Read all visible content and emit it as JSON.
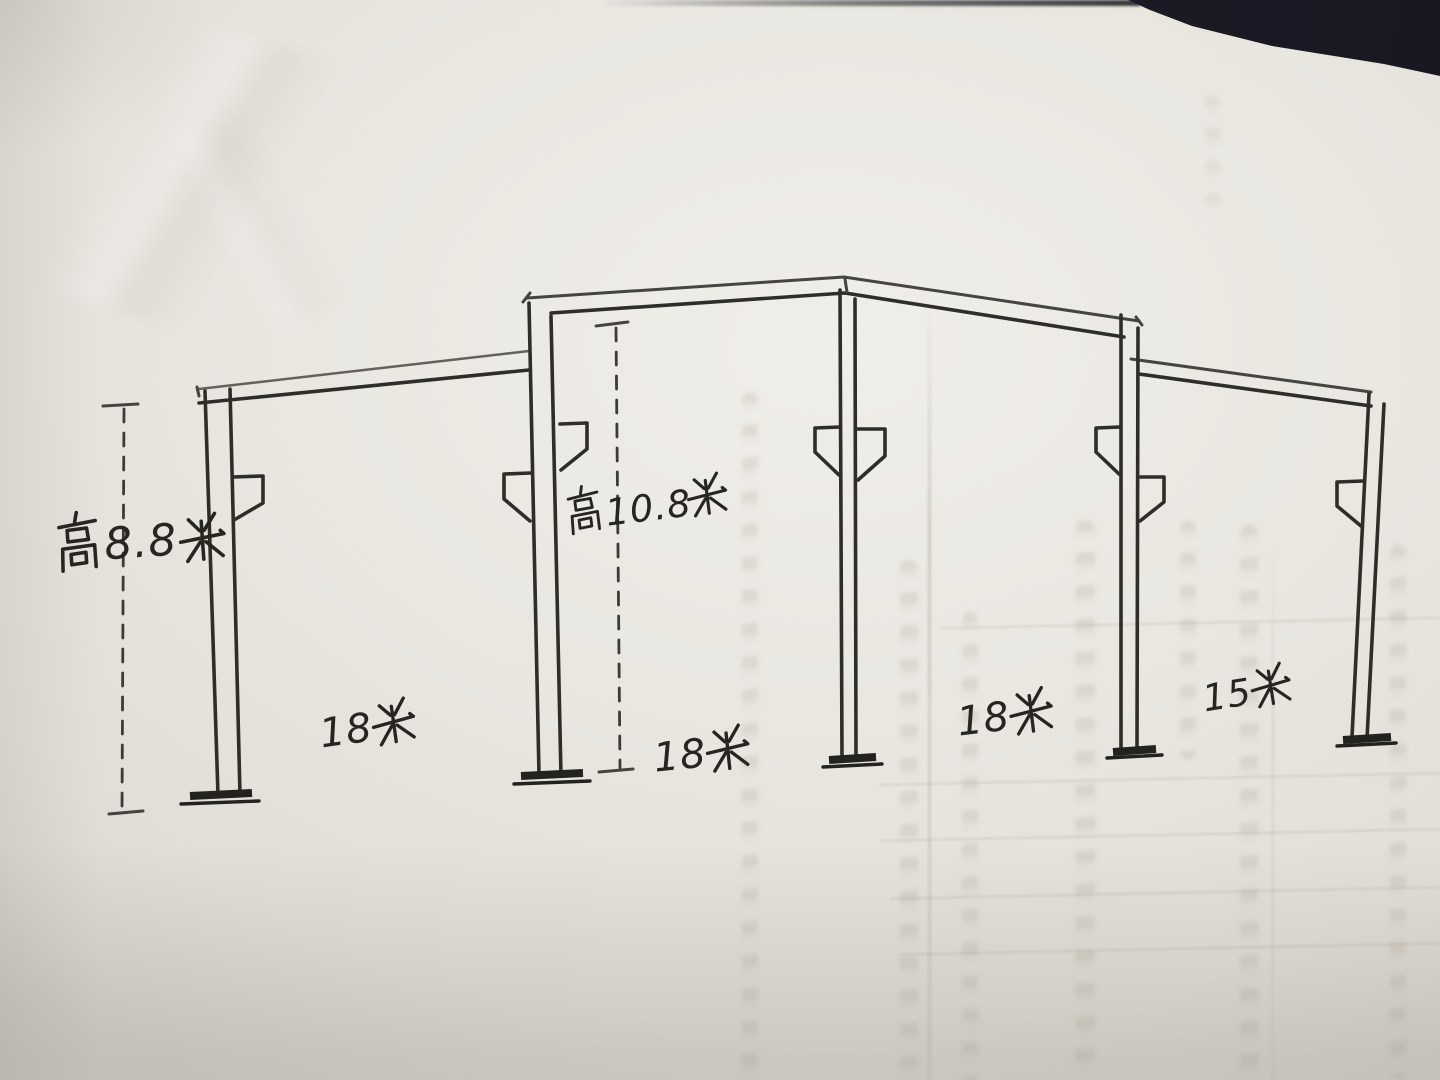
{
  "diagram": {
    "height_label_left": {
      "text": "高8.8米",
      "prefix": "高",
      "value": "8.8",
      "unit": "米"
    },
    "height_label_middle": {
      "text": "高10.8米",
      "prefix": "高",
      "value": "10.8",
      "unit": "米"
    },
    "span_labels": [
      {
        "text": "18米",
        "value": "18",
        "unit": "米"
      },
      {
        "text": "18米",
        "value": "18",
        "unit": "米"
      },
      {
        "text": "18米",
        "value": "18",
        "unit": "米"
      },
      {
        "text": "15米",
        "value": "15",
        "unit": "米"
      }
    ],
    "structure": {
      "columns": 5,
      "roof_beams": 3,
      "corbels": 8,
      "column_base_plates": 5,
      "dimension_lines": 2
    }
  },
  "colors": {
    "ink": "#2b2a26",
    "paper": "#e9e6e0",
    "background_dark": "#15151c",
    "bleed_through": "#968a78"
  }
}
